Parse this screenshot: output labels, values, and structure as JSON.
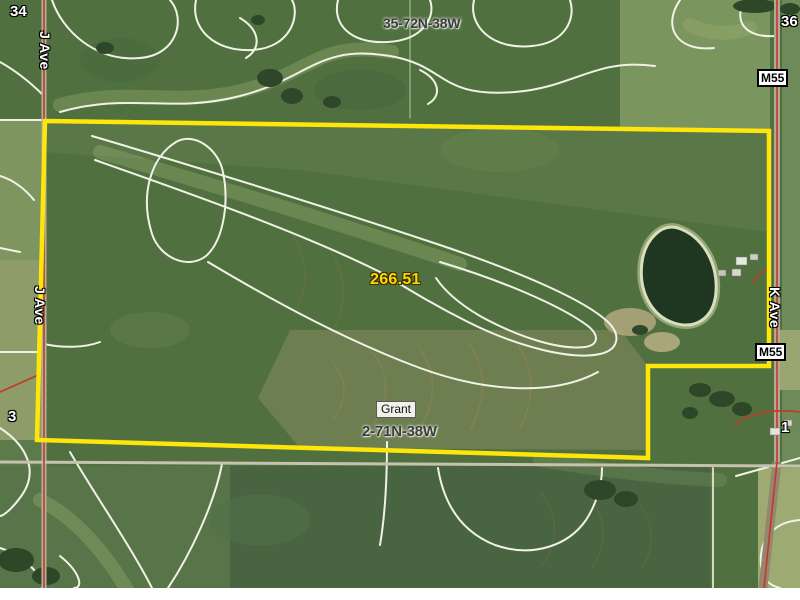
{
  "map": {
    "parcel": {
      "acreage_label": "266.51"
    },
    "township_top": "35-72N-38W",
    "township_bottom": "2-71N-38W",
    "township_name": "Grant",
    "sections": {
      "nw": "34",
      "ne": "36",
      "sw": "3",
      "se": "1"
    },
    "roads": {
      "west_road_top": "J Ave",
      "west_road_mid": "J Ave",
      "east_road": "K Ave",
      "highway_badge_top": "M55",
      "highway_badge_mid": "M55"
    },
    "colors": {
      "parcel_boundary": "#ffe60a",
      "acreage_text": "#ffd60a",
      "road_centerline": "#c03a28",
      "contour_line": "#f1f2e6"
    }
  }
}
